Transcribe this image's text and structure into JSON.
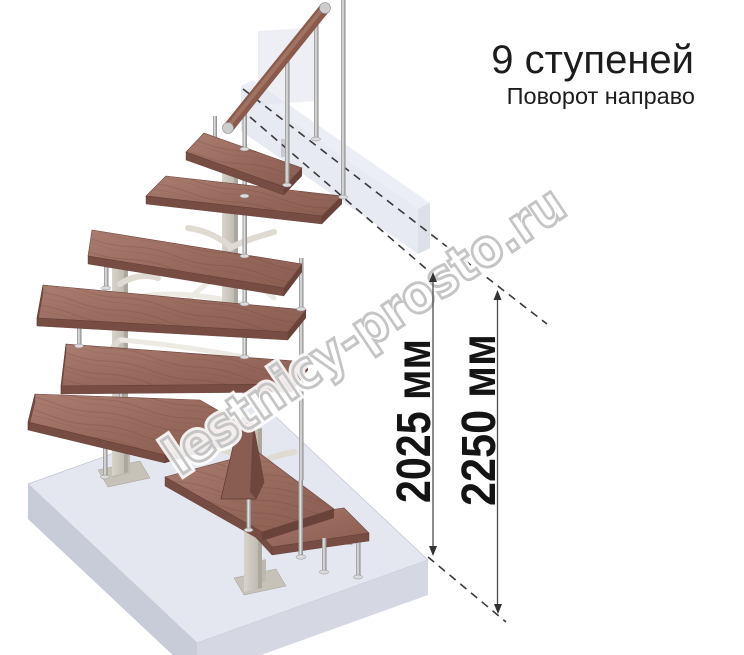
{
  "header": {
    "title": "9 ступеней",
    "subtitle": "Поворот направо"
  },
  "dimensions": [
    {
      "label": "2025 мм"
    },
    {
      "label": "2250 мм"
    }
  ],
  "watermark": "lestnicy-prosto.ru",
  "illustration": {
    "description": "3D render of a 9-step modular winder staircase turning right, on a floor slab, with wooden treads, chrome posts, wooden handrail and ghosted upper-floor slab",
    "steps_count": 9,
    "colors": {
      "wood_top": "#9a6d61",
      "wood_edge": "#774c43",
      "handrail_wood": "#8a5a4c",
      "chrome": "#c9c9c9",
      "steel_column": "#ccc8be",
      "floor_slab_top": "#e4e6f0",
      "floor_slab_left": "#c8cbd8",
      "floor_slab_right": "#d5d7e3",
      "ghost_wall": "#d5d9e7",
      "dashed_line": "#3a3a3a",
      "dimension_line": "#4d4d4d",
      "text": "#1c1c1c",
      "watermark_outline": "#c5c5c5"
    }
  }
}
